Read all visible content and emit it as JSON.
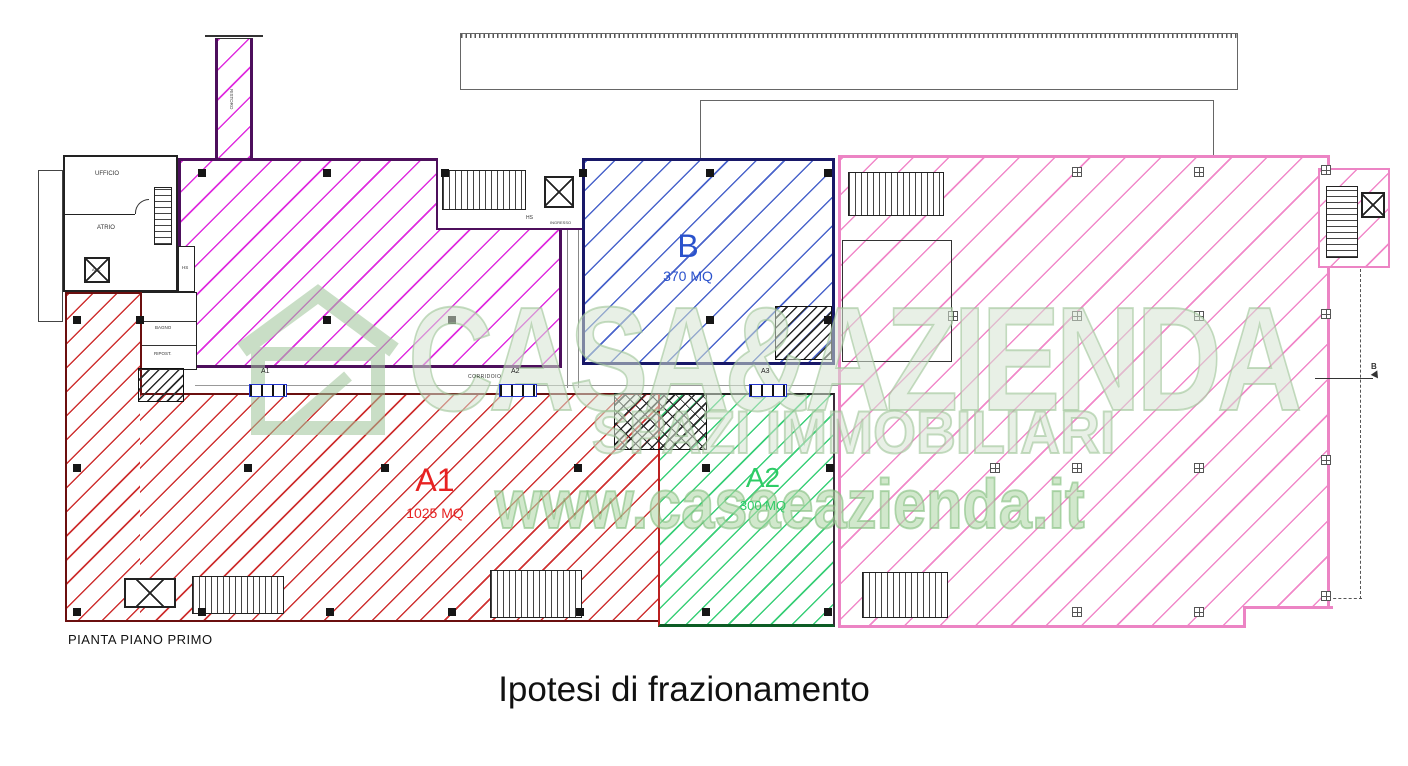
{
  "title": "Ipotesi di frazionamento",
  "plan_caption": "PIANTA PIANO PRIMO",
  "watermark": {
    "brand": "CASA&AZIENDA",
    "tagline": "SPAZI IMMOBILIARI",
    "url": "www.casaeazienda.it"
  },
  "zones": {
    "a1": {
      "label": "A1",
      "area": "1025 MQ",
      "color": "#e82222"
    },
    "a2": {
      "label": "A2",
      "area": "300 MQ",
      "color": "#2ecc66"
    },
    "b": {
      "label": "B",
      "area": "370 MQ",
      "color": "#2a52cc"
    },
    "right_wing": {
      "border_color": "#ec84c4"
    }
  },
  "rooms": {
    "ufficio": "UFFICIO",
    "atrio": "ATRIO",
    "asc": "ASC.",
    "hs": "HS",
    "bagno": "BAGNO",
    "ripost": "RIPOST.",
    "ristoro": "RISTORO",
    "ingresso": "INGRESSO",
    "corridoio": "CORRIDOIO"
  },
  "doors": [
    {
      "label": "A1"
    },
    {
      "label": "A2"
    },
    {
      "label": "A3"
    }
  ],
  "section": {
    "label": "B"
  }
}
